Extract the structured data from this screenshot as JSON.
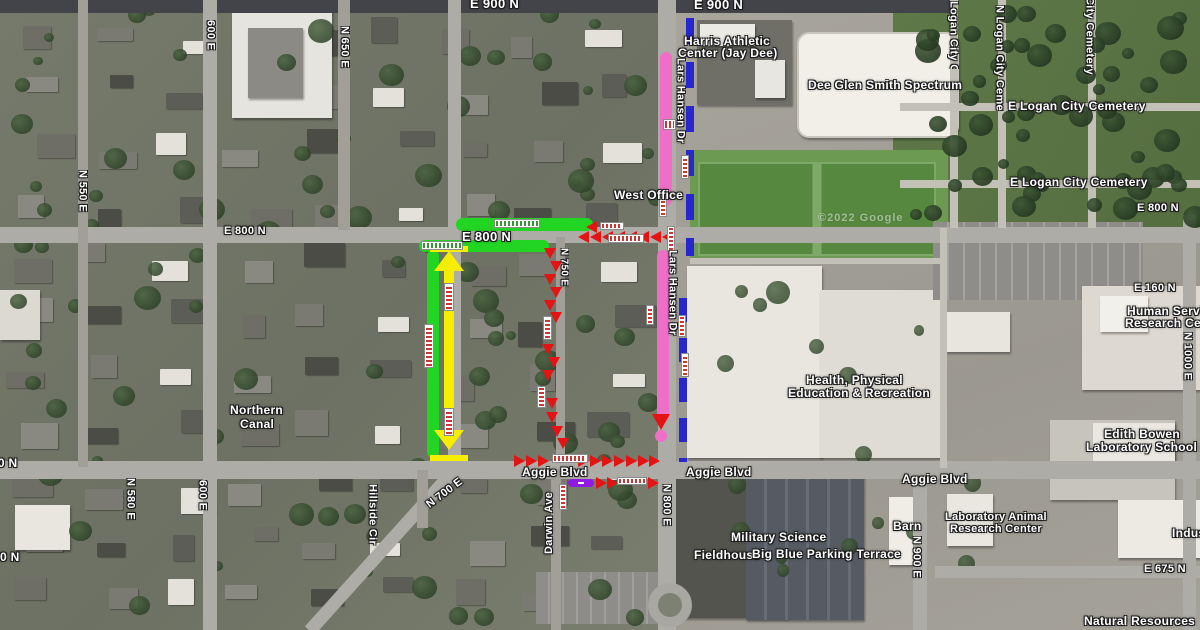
{
  "map": {
    "attribution": "©2022 Google",
    "streets": {
      "e900n_a": "E 900 N",
      "e900n_b": "E 900 N",
      "e800n_w": "E 800 N",
      "e800n_c": "E 800 N",
      "e800n_e": "E 800 N",
      "e700n": "E 700 N",
      "frag_0n": "0 N",
      "e675n": "E 675 N",
      "e160n": "E 160 N",
      "aggie_a": "Aggie Blvd",
      "aggie_b": "Aggie Blvd",
      "aggie_c": "Aggie Blvd",
      "n550e": "N 550 E",
      "n580e": "N 580 E",
      "n650e": "N 650 E",
      "e600_top": "600 E",
      "e600_bot": "600 E",
      "n700e_diag": "N 700 E",
      "n750e": "N 750 E",
      "n800e": "N 800 E",
      "n900e": "N 900 E",
      "n1000e": "N 1000 E",
      "darwin": "Darwin Ave",
      "hillside": "Hillside Cir",
      "lars_a": "Lars Hansen Dr",
      "lars_b": "Lars Hansen Dr",
      "cem_v1": "Logan City Ce",
      "cem_v2": "N Logan City Cemetery",
      "cem_v3": "City Cemetery",
      "cem_h1": "E Logan City Cemetery",
      "cem_h2": "E Logan City Cemetery"
    },
    "places": {
      "harris1": "Harris Athletic",
      "harris2": "Center (Jay Dee)",
      "spectrum": "Dee Glen Smith Spectrum",
      "west_office": "West Office",
      "hper1": "Health, Physical",
      "hper2": "Education & Recreation",
      "canal1": "Northern",
      "canal2": "Canal",
      "military": "Military Science",
      "fieldhouse": "Fieldhouse",
      "bigblue": "Big Blue Parking Terrace",
      "barn": "Barn",
      "lab1": "Laboratory Animal",
      "lab2": "Research Center",
      "human1": "Human Services",
      "human2": "Research Center",
      "edith1": "Edith Bowen",
      "edith2": "Laboratory School and",
      "natural": "Natural Resources",
      "indus": "Industrial"
    },
    "overlays": {
      "pink_route_color": "#ef6ec8",
      "blue_dashed_color": "#2727cd",
      "green_route_color": "#23d523",
      "yellow_detour_color": "#f6ee00",
      "red_arrow_color": "#e51414",
      "purple_segment_color": "#911ae3"
    }
  }
}
